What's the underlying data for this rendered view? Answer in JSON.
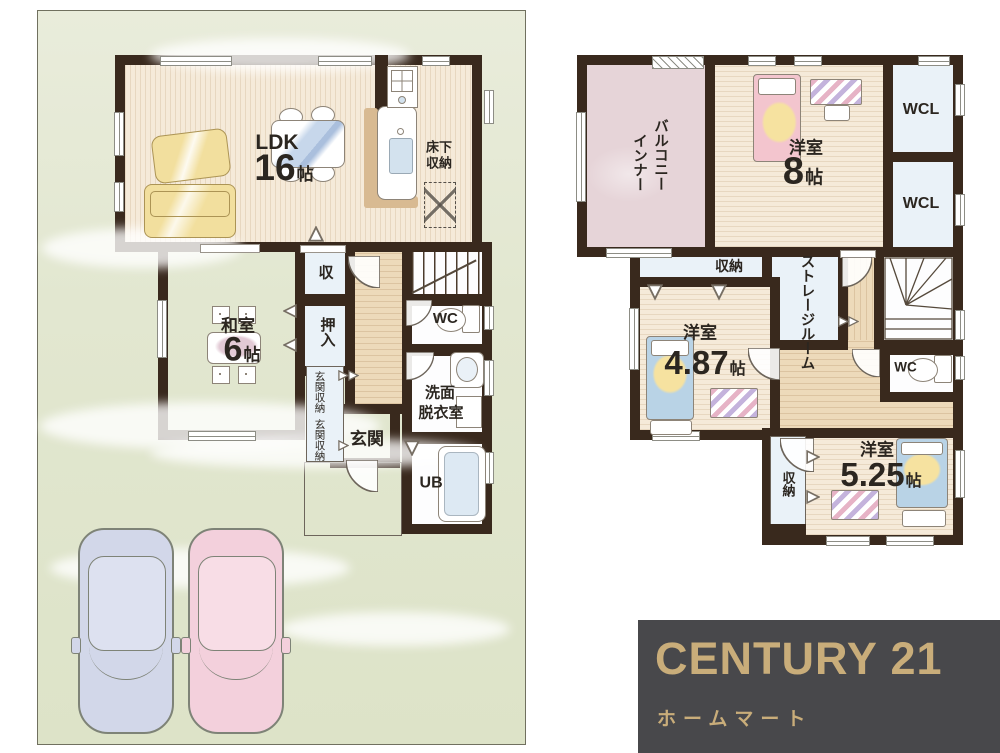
{
  "floor1": {
    "ldk": {
      "name": "LDK",
      "num": "16",
      "unit": "帖"
    },
    "yukashita_line1": "床下",
    "yukashita_line2": "収納",
    "washitsu": {
      "name": "和室",
      "num": "6",
      "unit": "帖"
    },
    "closet_small": "収",
    "oshiire": "押入",
    "genkan_storage_upper": "玄関収納",
    "genkan_storage_lower": "玄関収納",
    "genkan": "玄関",
    "wc": "WC",
    "senmen_line1": "洗面",
    "senmen_line2": "脱衣室",
    "unit_bath": "UB"
  },
  "floor2": {
    "inner_balcony_col1": "インナー",
    "inner_balcony_col2": "バルコニー",
    "bedroom8": {
      "name": "洋室",
      "num": "8",
      "unit": "帖"
    },
    "wcl_upper": "WCL",
    "wcl_lower": "WCL",
    "closet_top": "収納",
    "storage_room": "ストレージルーム",
    "bedroom487": {
      "name": "洋室",
      "num": "4.87",
      "unit": "帖"
    },
    "wc": "WC",
    "bedroom525": {
      "name": "洋室",
      "num": "5.25",
      "unit": "帖"
    },
    "closet_525": "収納"
  },
  "logo": {
    "brand": "CENTURY 21",
    "subtitle": "ホームマート"
  },
  "colors": {
    "wall": "#39291d",
    "lot_green": "#e2e7d0",
    "wood_floor": "#f5ead9",
    "tatami_green": "#e0e9d5",
    "balcony_mauve": "#e6d4d8",
    "closet_blue": "#eaf2f8",
    "hall_tan": "#eddaba",
    "logo_background": "#48484b",
    "logo_gold": "#c9ad7a"
  }
}
